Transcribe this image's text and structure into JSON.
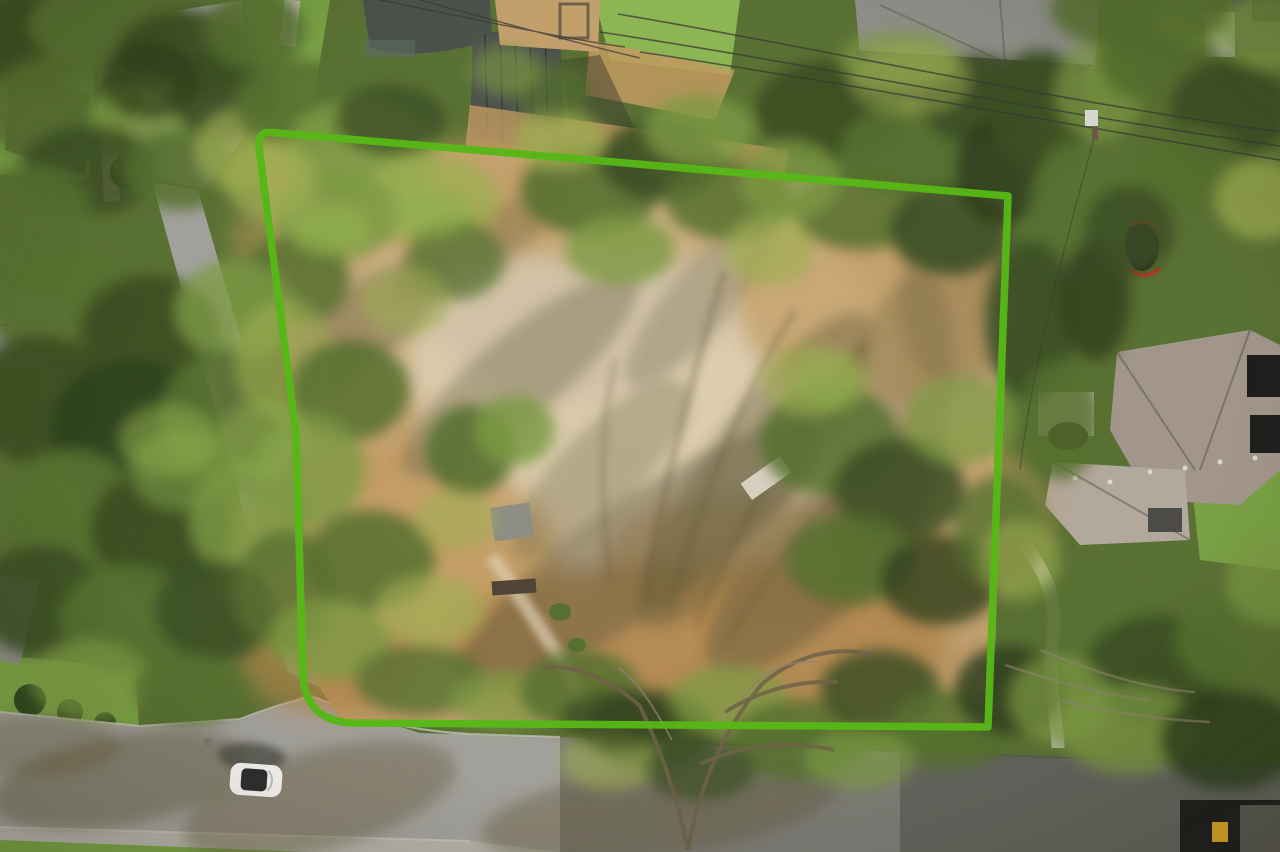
{
  "scene": {
    "description": "Aerial drone photograph of a cleared residential dirt lot outlined with a bright green property boundary, surrounded by dense trees, neighboring rooftops, a street with a white car at bottom left, and power lines crossing the top right."
  },
  "colors": {
    "boundary_green": "#57b717",
    "base_green": "#5a7134",
    "f_dark": "#3c4f24",
    "f_darker": "#2f401d",
    "f_mid": "#567030",
    "f_light": "#7d9a44",
    "f_yellow": "#9fae52",
    "f_bright": "#8fae4e",
    "d_light": "#dccdaf",
    "d_pale": "#cfc0a4",
    "d_gold": "#c29a60",
    "d_deep": "#ae8148",
    "dirt_edge": "#bd9a66",
    "s_olive": "#5f5839",
    "shadow_dark": "#3f3d30",
    "road_light": "#a3a19c",
    "road_mid": "#8f8d88",
    "road_shadow": "#5f5e57",
    "road_dark": "#4c4b45",
    "sidewalk": "#b5b2aa",
    "curb": "#c9c6bd",
    "lawn": "#79a145",
    "lawn_bright": "#8cb554",
    "hedge_dark": "#31481f",
    "roof_slate": "#4b524c",
    "roof_teal": "#5b6b60",
    "roof_gray": "#8f8e89",
    "seam_roof": "#4e524d",
    "shingle": "#a2968a",
    "shingle_light": "#b3a89c",
    "roof_black": "#1e1e1e",
    "wood_deck": "#c3a06b",
    "wall_stone": "#b9a88c",
    "path_concrete": "#c6c2b8",
    "car_body": "#f4f3f0",
    "car_glass": "#2e2e2e",
    "red_accent": "#c03a2a",
    "carport_yellow": "#d8a62a",
    "wire": "#3a3a36",
    "pole_wood": "#6b5b44",
    "pole_box": "#d9d7d2",
    "trunk": "#6e6149",
    "twig": "#8d8270",
    "manhole": "#7b7974",
    "shed_gray": "#8e8e86",
    "ramp_white": "#d8cfc0",
    "log_brown": "#4f4436"
  },
  "boundary": {
    "path": "M 1008 196 L 272 132.5 Q 257 131 259 147 L 296 434 L 303 676 Q 306 721 352 723 L 988 727 Z",
    "stroke_width": 7.5
  },
  "foliage": [
    [
      30,
      40,
      70,
      50,
      "f_dark",
      1
    ],
    [
      110,
      25,
      80,
      45,
      "f_mid",
      1
    ],
    [
      185,
      55,
      70,
      45,
      "f_dark",
      0.95
    ],
    [
      60,
      110,
      75,
      55,
      "f_mid",
      0.9
    ],
    [
      150,
      120,
      60,
      40,
      "f_light",
      0.85
    ],
    [
      225,
      95,
      55,
      45,
      "f_dark",
      0.9
    ],
    [
      90,
      170,
      70,
      45,
      "f_dark",
      0.85
    ],
    [
      30,
      210,
      60,
      45,
      "f_mid",
      0.9
    ],
    [
      180,
      170,
      55,
      40,
      "f_mid",
      0.85
    ],
    [
      240,
      150,
      45,
      40,
      "f_yellow",
      0.7
    ],
    [
      255,
      30,
      50,
      40,
      "f_mid",
      0.9
    ],
    [
      150,
      80,
      50,
      40,
      "f_darker",
      0.7
    ],
    [
      300,
      105,
      65,
      45,
      "f_mid",
      0.9
    ],
    [
      360,
      150,
      75,
      50,
      "f_light",
      0.9
    ],
    [
      430,
      200,
      70,
      45,
      "f_yellow",
      0.8
    ],
    [
      335,
      215,
      65,
      45,
      "f_light",
      0.85
    ],
    [
      295,
      280,
      55,
      45,
      "f_mid",
      0.85
    ],
    [
      390,
      120,
      55,
      35,
      "f_dark",
      0.8
    ],
    [
      270,
      180,
      45,
      40,
      "f_yellow",
      0.75
    ],
    [
      455,
      260,
      50,
      40,
      "f_mid",
      0.7
    ],
    [
      330,
      230,
      40,
      25,
      "f_bright",
      0.8
    ],
    [
      430,
      210,
      40,
      25,
      "f_bright",
      0.7
    ],
    [
      590,
      190,
      70,
      45,
      "f_mid",
      0.9
    ],
    [
      660,
      160,
      60,
      40,
      "f_dark",
      0.9
    ],
    [
      730,
      200,
      65,
      40,
      "f_mid",
      0.85
    ],
    [
      620,
      250,
      55,
      35,
      "f_light",
      0.8
    ],
    [
      700,
      130,
      55,
      35,
      "f_light",
      0.8
    ],
    [
      770,
      250,
      45,
      35,
      "f_yellow",
      0.7
    ],
    [
      560,
      140,
      45,
      30,
      "f_yellow",
      0.75
    ],
    [
      550,
      90,
      40,
      28,
      "f_mid",
      0.7
    ],
    [
      505,
      70,
      35,
      25,
      "f_light",
      0.6
    ],
    [
      830,
      110,
      75,
      50,
      "f_dark",
      0.95
    ],
    [
      910,
      150,
      70,
      45,
      "f_mid",
      0.9
    ],
    [
      975,
      100,
      55,
      45,
      "f_dark",
      0.9
    ],
    [
      860,
      210,
      65,
      40,
      "f_mid",
      0.85
    ],
    [
      950,
      230,
      60,
      45,
      "f_dark",
      0.9
    ],
    [
      1000,
      170,
      45,
      55,
      "f_darker",
      0.85
    ],
    [
      900,
      60,
      60,
      30,
      "f_light",
      0.7
    ],
    [
      790,
      180,
      50,
      40,
      "f_light",
      0.75
    ],
    [
      910,
      80,
      60,
      35,
      "f_yellow",
      0.5
    ],
    [
      1040,
      110,
      50,
      60,
      "f_dark",
      0.95
    ],
    [
      1075,
      210,
      45,
      70,
      "f_mid",
      0.9
    ],
    [
      1030,
      320,
      45,
      80,
      "f_dark",
      0.9
    ],
    [
      1060,
      420,
      40,
      60,
      "f_mid",
      0.85
    ],
    [
      1100,
      90,
      45,
      50,
      "f_light",
      0.7
    ],
    [
      1095,
      300,
      35,
      60,
      "f_darker",
      0.8
    ],
    [
      60,
      300,
      75,
      60,
      "f_mid",
      0.95
    ],
    [
      150,
      330,
      70,
      55,
      "f_dark",
      0.95
    ],
    [
      235,
      310,
      60,
      50,
      "f_light",
      0.8
    ],
    [
      40,
      400,
      70,
      65,
      "f_dark",
      0.95
    ],
    [
      130,
      430,
      80,
      70,
      "f_darker",
      0.9
    ],
    [
      225,
      420,
      65,
      70,
      "f_mid",
      0.9
    ],
    [
      70,
      510,
      70,
      60,
      "f_mid",
      0.95
    ],
    [
      160,
      530,
      70,
      60,
      "f_dark",
      0.95
    ],
    [
      250,
      520,
      60,
      60,
      "f_light",
      0.8
    ],
    [
      40,
      600,
      65,
      55,
      "f_dark",
      0.9
    ],
    [
      130,
      620,
      70,
      55,
      "f_mid",
      0.9
    ],
    [
      215,
      610,
      60,
      50,
      "f_dark",
      0.85
    ],
    [
      285,
      590,
      50,
      60,
      "f_mid",
      0.8
    ],
    [
      90,
      680,
      60,
      40,
      "f_light",
      0.7
    ],
    [
      190,
      690,
      55,
      35,
      "f_mid",
      0.8
    ],
    [
      285,
      360,
      50,
      60,
      "f_yellow",
      0.6
    ],
    [
      180,
      470,
      50,
      40,
      "f_light",
      0.6
    ],
    [
      170,
      440,
      50,
      35,
      "f_bright",
      0.55
    ],
    [
      350,
      390,
      60,
      50,
      "f_mid",
      0.85
    ],
    [
      310,
      470,
      55,
      55,
      "f_light",
      0.8
    ],
    [
      370,
      560,
      65,
      50,
      "f_mid",
      0.85
    ],
    [
      330,
      640,
      60,
      40,
      "f_light",
      0.8
    ],
    [
      430,
      610,
      55,
      35,
      "f_yellow",
      0.65
    ],
    [
      470,
      450,
      45,
      45,
      "f_mid",
      0.9
    ],
    [
      515,
      430,
      40,
      35,
      "f_light",
      0.85
    ],
    [
      455,
      520,
      40,
      30,
      "f_yellow",
      0.6
    ],
    [
      405,
      300,
      45,
      35,
      "f_yellow",
      0.55
    ],
    [
      420,
      680,
      65,
      35,
      "f_mid",
      0.8
    ],
    [
      505,
      700,
      55,
      30,
      "f_light",
      0.7
    ],
    [
      260,
      440,
      40,
      40,
      "f_bright",
      0.5
    ],
    [
      580,
      690,
      60,
      40,
      "f_mid",
      0.85
    ],
    [
      650,
      730,
      65,
      40,
      "f_dark",
      0.85
    ],
    [
      730,
      700,
      60,
      35,
      "f_light",
      0.75
    ],
    [
      800,
      740,
      70,
      40,
      "f_mid",
      0.85
    ],
    [
      880,
      690,
      60,
      40,
      "f_dark",
      0.85
    ],
    [
      950,
      730,
      60,
      40,
      "f_mid",
      0.85
    ],
    [
      1010,
      690,
      55,
      45,
      "f_darker",
      0.85
    ],
    [
      610,
      760,
      50,
      30,
      "f_yellow",
      0.6
    ],
    [
      700,
      770,
      55,
      30,
      "f_dark",
      0.7
    ],
    [
      860,
      760,
      55,
      30,
      "f_light",
      0.65
    ],
    [
      620,
      720,
      60,
      30,
      "f_darker",
      0.6
    ],
    [
      830,
      440,
      70,
      55,
      "f_mid",
      0.85
    ],
    [
      900,
      490,
      65,
      50,
      "f_dark",
      0.85
    ],
    [
      960,
      420,
      55,
      45,
      "f_light",
      0.75
    ],
    [
      850,
      560,
      65,
      45,
      "f_mid",
      0.85
    ],
    [
      940,
      580,
      60,
      45,
      "f_darker",
      0.8
    ],
    [
      1000,
      530,
      45,
      55,
      "f_mid",
      0.8
    ],
    [
      810,
      380,
      50,
      35,
      "f_yellow",
      0.6
    ],
    [
      830,
      380,
      40,
      30,
      "f_bright",
      0.5
    ],
    [
      1090,
      620,
      65,
      55,
      "f_mid",
      0.9
    ],
    [
      1160,
      670,
      75,
      55,
      "f_dark",
      0.9
    ],
    [
      1240,
      640,
      65,
      50,
      "f_mid",
      0.9
    ],
    [
      1130,
      730,
      70,
      45,
      "f_light",
      0.75
    ],
    [
      1230,
      740,
      70,
      50,
      "f_darker",
      0.85
    ],
    [
      1060,
      700,
      50,
      45,
      "f_light",
      0.7
    ],
    [
      1275,
      580,
      50,
      45,
      "f_light",
      0.7
    ],
    [
      1020,
      560,
      40,
      40,
      "f_yellow",
      0.55
    ],
    [
      1160,
      60,
      60,
      45,
      "f_mid",
      0.9
    ],
    [
      1230,
      110,
      60,
      50,
      "f_dark",
      0.9
    ],
    [
      1270,
      30,
      50,
      40,
      "f_light",
      0.8
    ],
    [
      1190,
      170,
      55,
      45,
      "f_mid",
      0.85
    ],
    [
      1260,
      200,
      45,
      40,
      "f_yellow",
      0.7
    ],
    [
      1130,
      230,
      45,
      45,
      "f_dark",
      0.85
    ],
    [
      1190,
      20,
      40,
      25,
      "f_bright",
      0.7
    ],
    [
      1140,
      10,
      90,
      40,
      "f_mid",
      0.85
    ]
  ],
  "dirt_patches": [
    [
      650,
      380,
      240,
      190,
      "d_light",
      0.9
    ],
    [
      575,
      295,
      150,
      110,
      "d_pale",
      0.75
    ],
    [
      390,
      560,
      170,
      110,
      "d_gold",
      0.8
    ],
    [
      700,
      645,
      250,
      85,
      "d_deep",
      0.75
    ],
    [
      330,
      660,
      90,
      55,
      "d_deep",
      0.7
    ],
    [
      875,
      300,
      140,
      105,
      "d_gold",
      0.7
    ],
    [
      470,
      200,
      120,
      60,
      "d_gold",
      0.6
    ],
    [
      620,
      210,
      150,
      55,
      "d_gold",
      0.55
    ],
    [
      940,
      520,
      110,
      85,
      "d_gold",
      0.55
    ],
    [
      760,
      560,
      160,
      70,
      "d_deep",
      0.5
    ],
    [
      340,
      430,
      90,
      60,
      "d_gold",
      0.6
    ],
    [
      300,
      240,
      70,
      45,
      "d_gold",
      0.5
    ]
  ],
  "shadow_patches": [
    [
      640,
      555,
      220,
      55,
      "s_olive",
      0.45,
      -35
    ],
    [
      755,
      470,
      190,
      50,
      "s_olive",
      0.4,
      -55
    ],
    [
      825,
      555,
      160,
      55,
      "s_olive",
      0.45,
      -45
    ],
    [
      890,
      430,
      55,
      160,
      "s_olive",
      0.3,
      12
    ],
    [
      520,
      375,
      150,
      42,
      "s_olive",
      0.35,
      -40
    ],
    [
      355,
      330,
      110,
      38,
      "s_olive",
      0.4,
      -35
    ],
    [
      700,
      300,
      110,
      32,
      "s_olive",
      0.28,
      -50
    ],
    [
      600,
      470,
      120,
      40,
      "s_olive",
      0.3,
      -45
    ],
    [
      960,
      300,
      60,
      90,
      "s_olive",
      0.25,
      0
    ],
    [
      470,
      250,
      90,
      30,
      "s_olive",
      0.3,
      -30
    ],
    [
      120,
      780,
      130,
      45,
      "s_olive",
      0.45,
      -10
    ],
    [
      320,
      800,
      140,
      50,
      "s_olive",
      0.4,
      -15
    ],
    [
      40,
      745,
      80,
      30,
      "s_olive",
      0.35,
      0
    ],
    [
      660,
      810,
      180,
      45,
      "s_olive",
      0.4,
      -8
    ]
  ]
}
